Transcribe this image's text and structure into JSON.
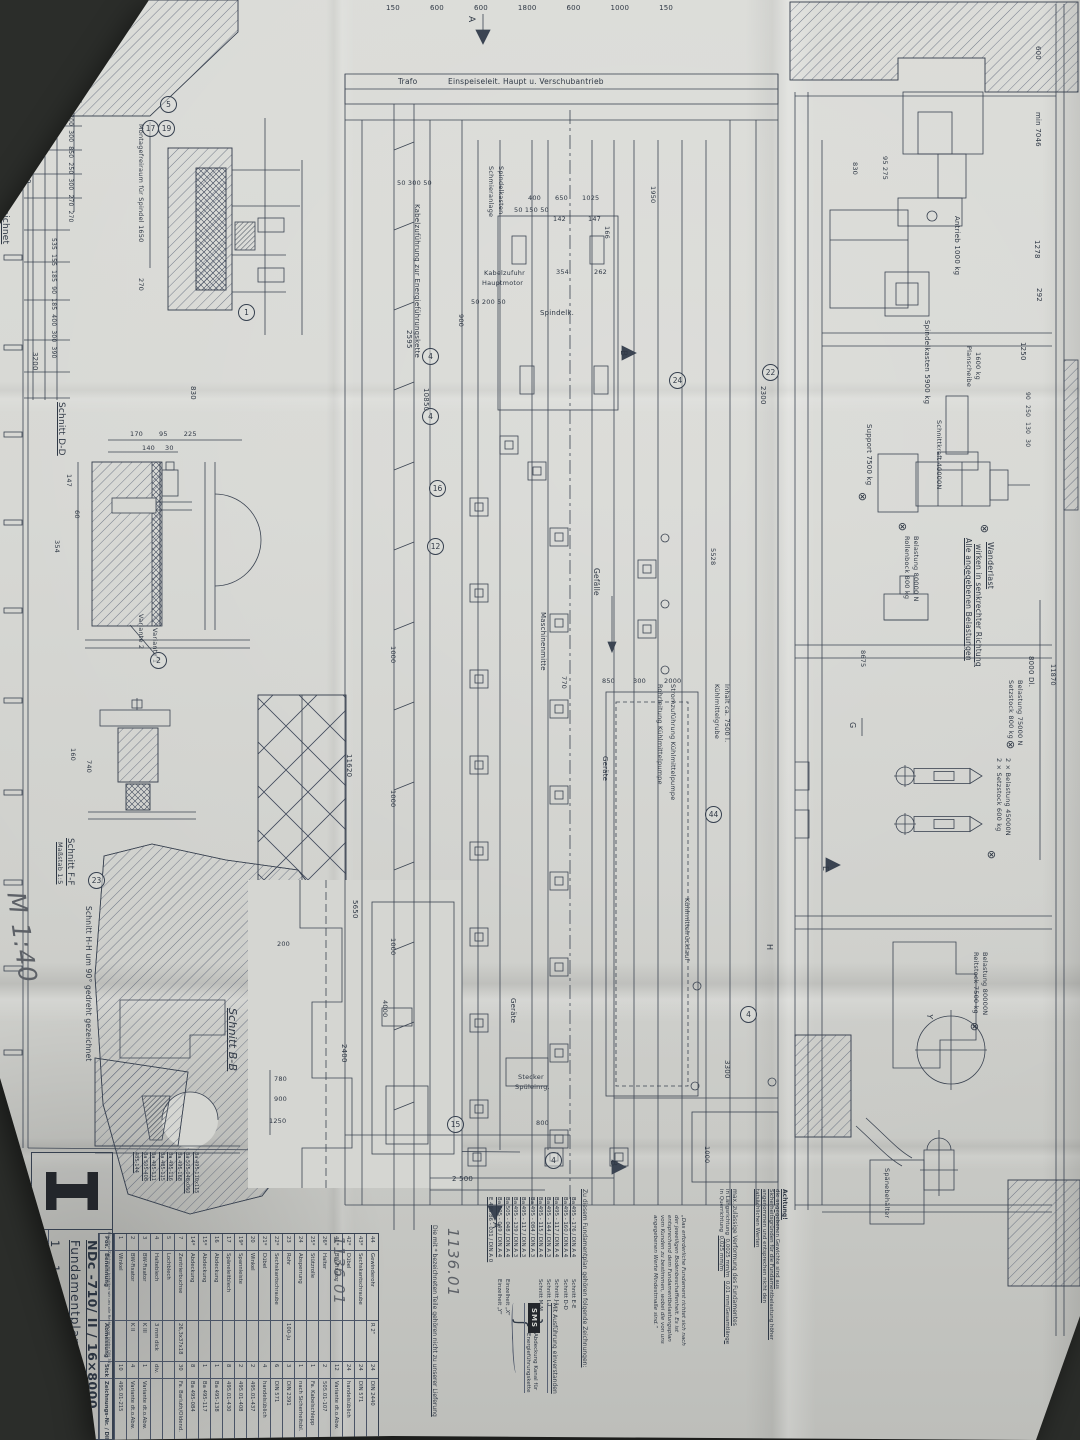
{
  "handwritten": {
    "scale": "M 1:40",
    "job_number": "1136.01"
  },
  "icons": {
    "load_point": "⊗"
  },
  "letters": {
    "a": "A",
    "b": "B",
    "e": "E",
    "g": "G",
    "h": "H",
    "y": "Y"
  },
  "sections": {
    "schnitt_cc": "Schnitt C-C  um 90° gedreht gezeichnet",
    "schnitt_dd": "Schnitt D-D",
    "schnitt_ff": "Schnitt F-F",
    "masstab_15": "Maßstab 1:5",
    "schnitt_hh": "Schnitt H-H  um 90° gedreht gezeichnet",
    "schnitt_bb": "Schnitt B-B",
    "variante_1": "Variante 1",
    "variante_2": "Variante 2",
    "montagefreiraum": "Montagefreiraum für Spindel 1650"
  },
  "plan": {
    "trafo": "Trafo",
    "einspeise": "Einspeiseleit. Haupt u. Verschubantrieb",
    "kabelzufuehrung": "Kabelzuführung zur Energieführungskette",
    "kabelzufuhr_1": "Kabelzufuhr",
    "kabelzufuhr_2": "Hauptmotor",
    "schmier_1": "Schmieranlage",
    "schmier_2": "Spindelkasten",
    "spindelk": "Spindelk.",
    "gefaelle": "Gefälle",
    "maschinenmitte": "Maschinenmitte",
    "geraete": "Geräte",
    "grube_1": "Kühlmittelgrube",
    "grube_2": "Inhalt ca. 7500 l.",
    "strom": "Stromzuführung Kühlmittelpumpe",
    "rohrleitung": "Rohrleitung Kühlmittelpumpe",
    "ruecklauf": "Kühlmittelrücklauf",
    "stecker_1": "Stecker",
    "stecker_2": "Spüleinrg."
  },
  "elev": {
    "antrieb": "Antrieb 1000 kg",
    "spindelkasten": "Spindelkasten 5900 kg",
    "planscheibe_1": "Planscheibe",
    "planscheibe_2": "1600 kg",
    "schnittkraft": "Schnittkraft 40000N",
    "support": "Support 7500 kg",
    "rollenbock_1": "Rollenbock 800 kg",
    "rollenbock_2": "Belastung 80000 N",
    "wanderlast": "Wanderlast",
    "alle_1": "Alle angegebenen Belastungen",
    "alle_2": "wirken in senkrechter Richtung",
    "setz800_1": "Setzstock 800 kg",
    "setz800_2": "Belastung 75000 N",
    "setz600_1": "2 × Setzstock 600 kg",
    "setz600_2": "2 × Belastung 45000N",
    "reitstock_1": "Reitstock 7500 kg",
    "reitstock_2": "Belastung 80000N",
    "spaenebehaelter": "Spänebehälter",
    "dl8000": "8000 Dl."
  },
  "dims": {
    "top_chain": [
      "150",
      "600",
      "600",
      "1800",
      "600",
      "1000",
      "150"
    ],
    "cc_ladder_a": [
      "500",
      "200",
      "300",
      "300",
      "850",
      "250",
      "300",
      "270",
      "270"
    ],
    "cc_ladder_b": [
      "535",
      "155",
      "185",
      "90",
      "185",
      "400",
      "300",
      "390"
    ],
    "right_small": [
      "90",
      "250",
      "130",
      "30"
    ],
    "dd_top": [
      "170",
      "95",
      "225"
    ],
    "dd_top2": [
      "140",
      "30"
    ],
    "mid_chain": [
      "850",
      "300",
      "2000"
    ],
    "spindel_chain": [
      "400",
      "650",
      "1025"
    ],
    "d": {
      "d5950": "5950",
      "d7700": "7700",
      "d500": "500",
      "d3200": "3200",
      "d830": "830",
      "d270": "270",
      "d147l": "147",
      "d60": "60",
      "d354l": "354",
      "d50_300_50": "50  300  50",
      "d50_150_50": "50 150 50",
      "d50_200_50": "50 200 50",
      "d142": "142",
      "d147": "147",
      "d354": "354",
      "d262": "262",
      "d166": "166",
      "d2595": "2595",
      "d10850": "10850",
      "d900": "900",
      "d1950": "1950",
      "d2300": "2300",
      "d770": "770",
      "d5528": "5528",
      "d11620": "11620",
      "d5650": "5650",
      "d2400": "2400",
      "d1000": "1000",
      "d4000": "4000",
      "d3300": "3300",
      "d2500": "2 500",
      "d800": "800",
      "d200": "200",
      "d780": "780",
      "d900b": "900",
      "d1250b": "1250",
      "d160": "160",
      "d740": "740",
      "d600": "600",
      "dmin7046": "min 7046",
      "d1278": "1278",
      "d292": "292",
      "d1250": "1250",
      "d95_275": "95  275",
      "d8675": "8675",
      "d11870": "11870"
    }
  },
  "balloons": {
    "b1": "1",
    "b2": "2",
    "b4": "4",
    "b5": "5",
    "b12": "12",
    "b15": "15",
    "b16": "16",
    "b17": "17",
    "b19": "19",
    "b22": "22",
    "b23": "23",
    "b24": "24",
    "b44": "44"
  },
  "title_block": {
    "rights_note": "Für diese Zeichnung behalten wir uns alle Rechte vor (siehe DIN 34)",
    "model": "NDc -710/ II / 16×8000",
    "title": "Fundamentplan",
    "order_no": "1 1 3 6 0 1",
    "drawing_no": "F495-05",
    "columns": [
      "Pos.",
      "Benennung",
      "Abmessung",
      "Stck",
      "Zeichnungs-Nr. / DIN"
    ],
    "parts": [
      {
        "pos": "44",
        "name": "Gewinderohr",
        "dim": "R 2\"",
        "qty": "24",
        "ref": "DIN 2440"
      },
      {
        "pos": "43*",
        "name": "Sechskantschraube",
        "dim": "",
        "qty": "24",
        "ref": "DIN 571"
      },
      {
        "pos": "42*",
        "name": "Dübel",
        "dim": "",
        "qty": "24",
        "ref": "handelsüblich"
      },
      {
        "pos": "41*",
        "name": "BW-Fixator",
        "dim": "",
        "qty": "12",
        "ref": "Variante dt.o.Abw."
      },
      {
        "pos": "26*",
        "name": "Halter",
        "dim": "",
        "qty": "2",
        "ref": "505.01-107"
      },
      {
        "pos": "25*",
        "name": "Stützrolle",
        "dim": "",
        "qty": "1",
        "ref": "Fa. Kabelschlepp"
      },
      {
        "pos": "24",
        "name": "Absperrung",
        "dim": "",
        "qty": "1",
        "ref": "nach Sicherheitsbl."
      },
      {
        "pos": "23",
        "name": "Rohr",
        "dim": "100-Ju",
        "qty": "3",
        "ref": "DIN 2391"
      },
      {
        "pos": "22*",
        "name": "Sechskantschraube",
        "dim": "",
        "qty": "6",
        "ref": "DIN 571"
      },
      {
        "pos": "21*",
        "name": "Dübel",
        "dim": "",
        "qty": "4",
        "ref": "handelsüblich"
      },
      {
        "pos": "20",
        "name": "Winkel",
        "dim": "",
        "qty": "2",
        "ref": "495.01-437"
      },
      {
        "pos": "19*",
        "name": "Spannleiste",
        "dim": "",
        "qty": "2",
        "ref": "495.01-408"
      },
      {
        "pos": "17",
        "name": "Späneleitblech",
        "dim": "",
        "qty": "8",
        "ref": "495.01-430"
      },
      {
        "pos": "16",
        "name": "Abdeckung",
        "dim": "",
        "qty": "1",
        "ref": "Ba 495-138"
      },
      {
        "pos": "15*",
        "name": "Abdeckung",
        "dim": "",
        "qty": "1",
        "ref": "Ba 495-117"
      },
      {
        "pos": "14*",
        "name": "Abdeckung",
        "dim": "",
        "qty": "8",
        "ref": "Ba 495-084"
      },
      {
        "pos": "7",
        "name": "Zentrierbuchse",
        "dim": "26,3x37x18",
        "qty": "30",
        "ref": "Fa. Barluth/Oldend."
      },
      {
        "pos": "5",
        "name": "Lochblech",
        "dim": "",
        "qty": "",
        "ref": ""
      },
      {
        "pos": "4",
        "name": "Halteblech",
        "dim": "3 mm dick",
        "qty": "div.",
        "ref": ""
      },
      {
        "pos": "3",
        "name": "BW-Fixator",
        "dim": "K III",
        "qty": "1",
        "ref": "Variante dt.o.Abw."
      },
      {
        "pos": "2",
        "name": "BW-Fixator",
        "dim": "K II",
        "qty": "4",
        "ref": "Variante dt.o.Abw."
      },
      {
        "pos": "1",
        "name": "Winkel",
        "dim": "",
        "qty": "10",
        "ref": "495.01-215"
      }
    ],
    "margin_refs": [
      "Ba 495-110x115",
      "Ba 505-048x060",
      "Ba 495-168",
      "Ba 495-116",
      "Ba 485-115",
      "Ba 495-111",
      "Ba 505-408",
      "485-144"
    ]
  },
  "notes": {
    "attention_title": "Achtung!",
    "attention_body": "die angegebenen Gewichte sind aus Sicherheitsgründen für die Fundamentbelastung höher angenommen und entsprechen nicht den tatsächlichen Werten",
    "deform_title": "max. zulässige Verformung des Fundamentes",
    "deform_l1a": "in Längsrichtung",
    "deform_l1b": "0,0025 mm/m",
    "deform_l1c": "0,01  mm/Gesamtlänge",
    "deform_l2a": "in Querrichtung",
    "deform_l2b": "0,025  mm/m",
    "foundation": "„Das erforderliche Fundament richtet sich nach der jeweiligen Bodenbeschaffenheit. Es ist entsprechend dem Fundamentbelastungsplan vom Kunden zu bestimmen, wobei die von uns angegebenen Werte Mindestmaße sind.“",
    "drawings_header": "Zu diesem Fundamentplan gehören folgende Zeichnungen:",
    "drawings": [
      {
        "no": "Ba 495 - 176 / DIN A 4",
        "name": "Schnitt E-E"
      },
      {
        "no": "Ba 495 - 160 / DIN A 4",
        "name": "Schnitt D-D"
      },
      {
        "no": "Ba 495 - 117 / DIN A 4",
        "name": "Schnitt J-J"
      },
      {
        "no": "Ba 495 - 144 / DIN A 3",
        "name": "Schnitt L-L"
      },
      {
        "no": "Ba 495 - 115 / DIN A 4",
        "name": "Schnitt M-M"
      },
      {
        "no": "Ba 495 - 084 / DIN A 3",
        "name": ""
      },
      {
        "no": "Ba 495 - 117 / DIN A 3",
        "name": ""
      },
      {
        "no": "Ba 495 - 139 / DIN A 3",
        "name": ""
      },
      {
        "no": "Ba 505 - 048 / DIN A 4",
        "name": "Einzelheit „X“"
      },
      {
        "no": "Ba 505 - 049 / DIN A 4",
        "name": "Einzelheit „Y“"
      },
      {
        "no": "E 495.86 - 031 / DIN A 0",
        "name": ""
      }
    ],
    "drawings_group_label": "Abdeckung Kanal für Energieführungskette",
    "star_note": "Die mit * bezeichneten Teile gehören nicht zu unserer Lieferung",
    "approval": "Mit Ausführung einverstanden",
    "company": "SMS"
  }
}
